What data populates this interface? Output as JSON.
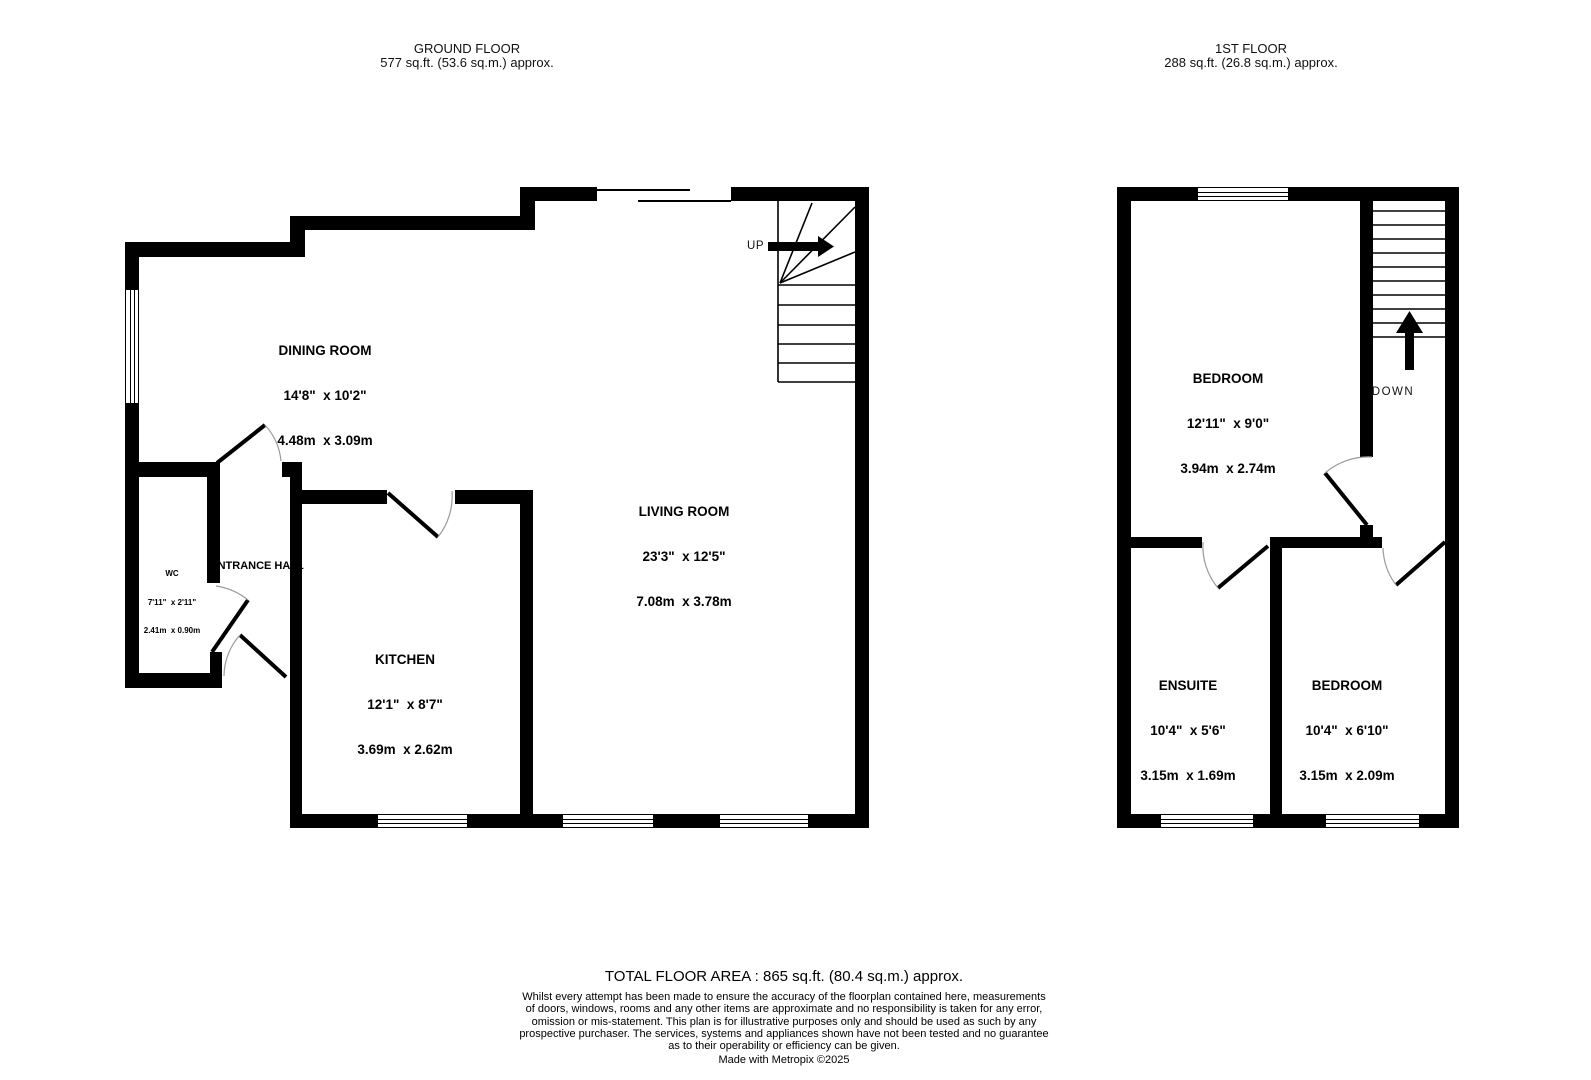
{
  "ground_floor": {
    "title": "GROUND FLOOR",
    "area": "577 sq.ft. (53.6 sq.m.) approx.",
    "stairs_label": "UP",
    "rooms": {
      "dining": {
        "name": "DINING ROOM",
        "imperial": "14'8\"  x 10'2\"",
        "metric": "4.48m  x 3.09m"
      },
      "living": {
        "name": "LIVING ROOM",
        "imperial": "23'3\"  x 12'5\"",
        "metric": "7.08m  x 3.78m"
      },
      "kitchen": {
        "name": "KITCHEN",
        "imperial": "12'1\"  x 8'7\"",
        "metric": "3.69m  x 2.62m"
      },
      "wc": {
        "name": "WC",
        "imperial": "7'11\"  x 2'11\"",
        "metric": "2.41m  x 0.90m"
      },
      "entrance": {
        "name": "ENTRANCE HALL"
      }
    }
  },
  "first_floor": {
    "title": "1ST FLOOR",
    "area": "288 sq.ft. (26.8 sq.m.) approx.",
    "stairs_label": "DOWN",
    "rooms": {
      "bedroom1": {
        "name": "BEDROOM",
        "imperial": "12'11\"  x 9'0\"",
        "metric": "3.94m  x 2.74m"
      },
      "ensuite": {
        "name": "ENSUITE",
        "imperial": "10'4\"  x 5'6\"",
        "metric": "3.15m  x 1.69m"
      },
      "bedroom2": {
        "name": "BEDROOM",
        "imperial": "10'4\"  x 6'10\"",
        "metric": "3.15m  x 2.09m"
      }
    }
  },
  "footer": {
    "total": "TOTAL FLOOR AREA : 865 sq.ft. (80.4 sq.m.) approx.",
    "disclaimer_lines": [
      "Whilst every attempt has been made to ensure the accuracy of the floorplan contained here, measurements",
      "of doors, windows, rooms and any other items are approximate and no responsibility is taken for any error,",
      "omission or mis-statement. This plan is for illustrative purposes only and should be used as such by any",
      "prospective purchaser. The services, systems and appliances shown have not been tested and no guarantee",
      "as to their operability or efficiency can be given.",
      "Made with Metropix ©2025"
    ]
  }
}
